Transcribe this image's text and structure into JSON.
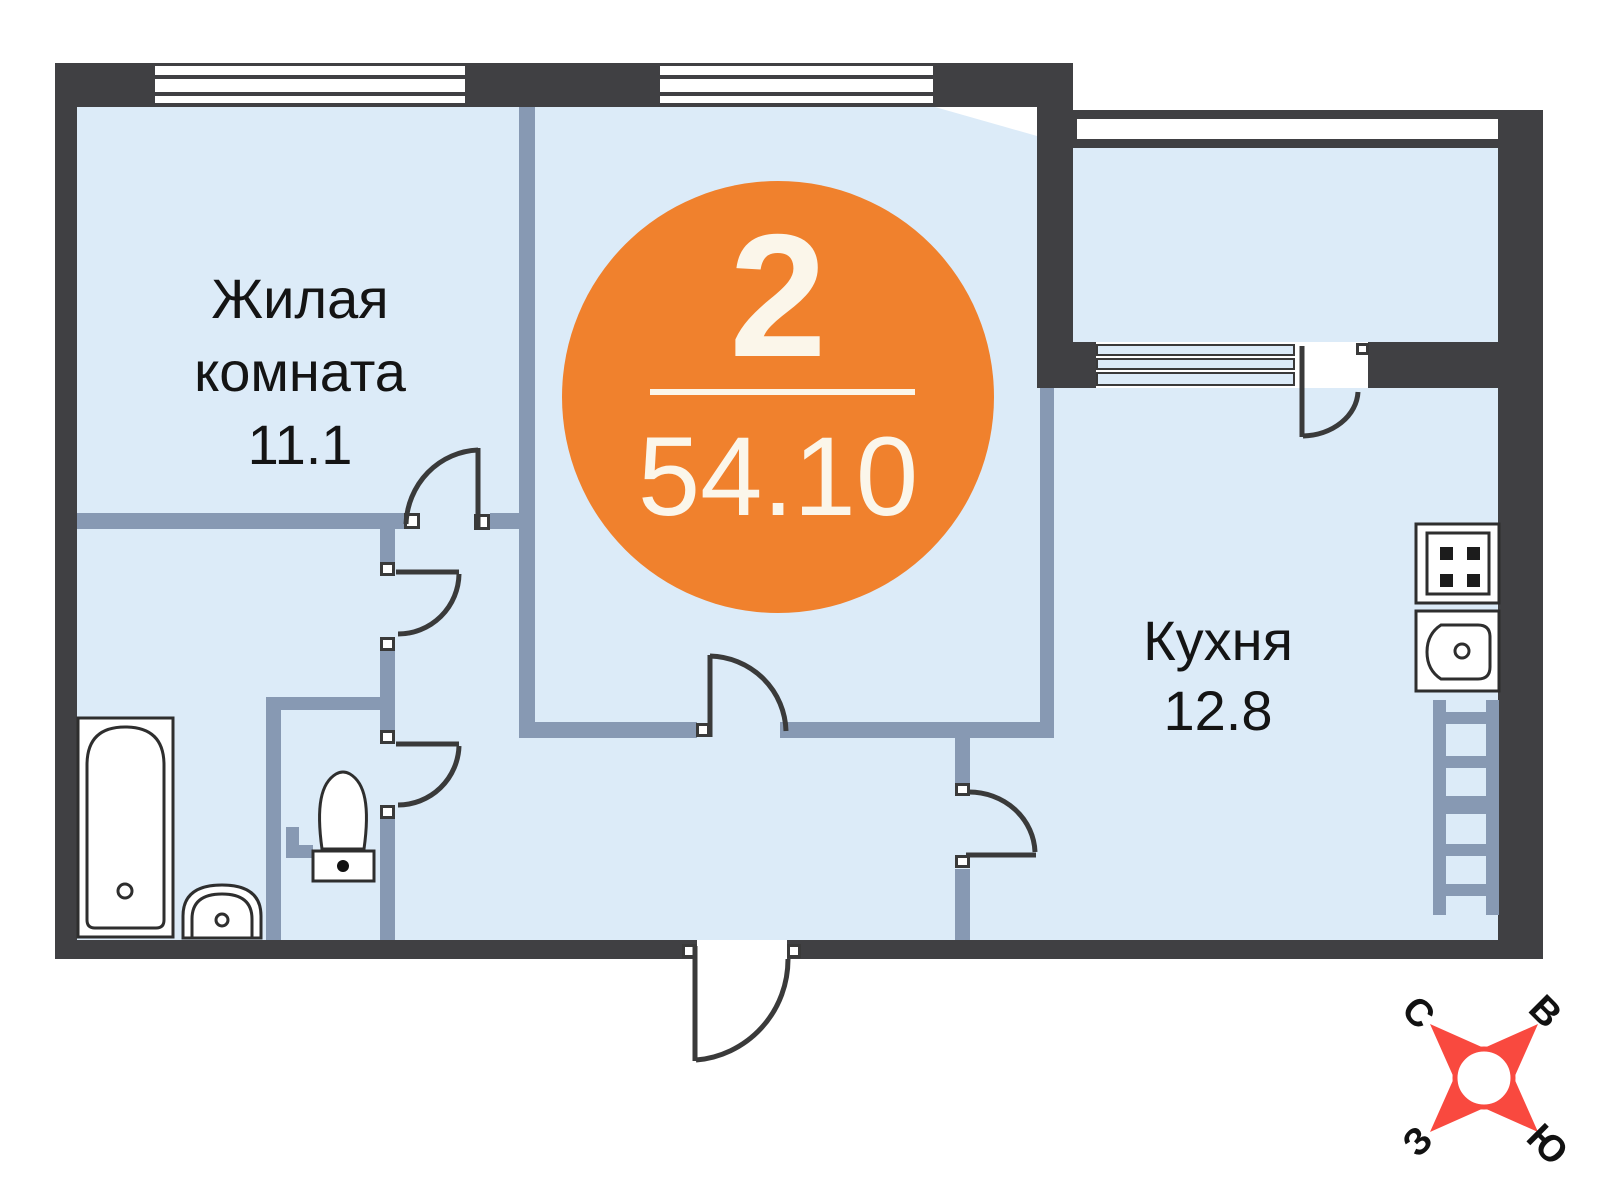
{
  "badge": {
    "room_count": "2",
    "total_area": "54.10"
  },
  "rooms": {
    "living": {
      "line1": "Жилая",
      "line2": "комната",
      "area": "11.1"
    },
    "kitchen": {
      "name": "Кухня",
      "area": "12.8"
    }
  },
  "compass": {
    "north": "С",
    "east": "В",
    "west": "З",
    "south": "Ю"
  },
  "colors": {
    "wall_dark": "#404043",
    "partition_slate": "#8799b3",
    "room_fill": "#dcebf8",
    "badge_orange": "#f0812d",
    "badge_text": "#fbf6ea",
    "compass_red": "#f9493f"
  }
}
